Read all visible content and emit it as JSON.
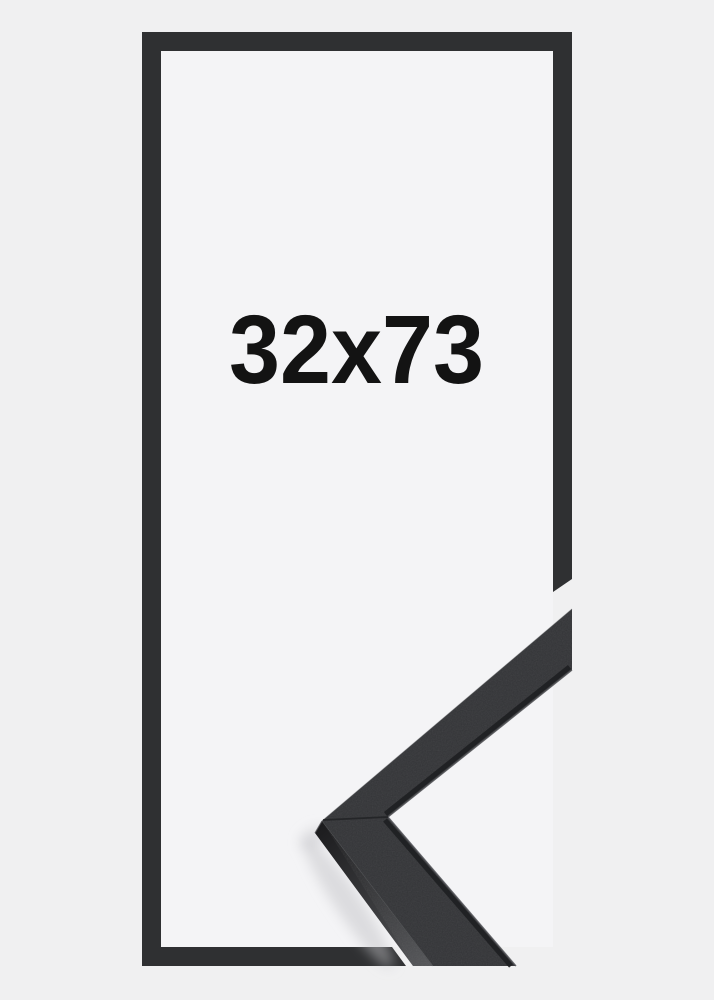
{
  "image": {
    "size_label": "32x73",
    "description_names": {
      "outline": "frame-outline",
      "corner": "frame-corner-sample"
    }
  },
  "colors": {
    "background": "#f0f0f1",
    "frame_interior": "#f4f4f6",
    "frame_outline": "#2f3032",
    "moulding_top": "#333437",
    "moulding_side_start": "#1b1b1d",
    "moulding_side_end": "#545558",
    "outer_arris_highlight": "#4a4b4e",
    "inner_edge_highlight": "#55565a",
    "lip_shadow": "#1e1f21",
    "seam": "#212224",
    "corner_edge_highlight": "#525356",
    "text": "#131313",
    "shadow": "#c4c4c8"
  }
}
